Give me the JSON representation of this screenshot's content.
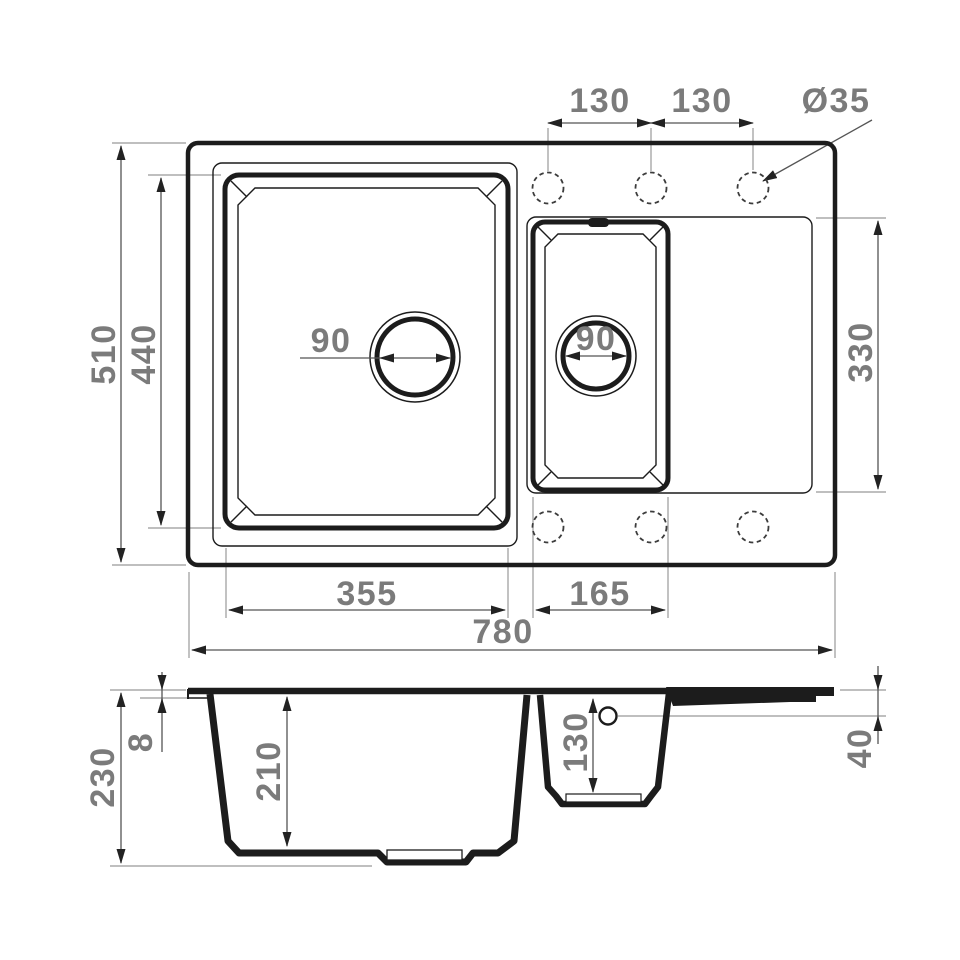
{
  "drawing": {
    "kind": "kitchen-sink-dimension-drawing",
    "units": "mm",
    "views": [
      "top-view",
      "section-view"
    ]
  },
  "top_view": {
    "tap_spacing_left": "130",
    "tap_spacing_right": "130",
    "tap_hole_diameter": "Ø35",
    "overall_depth": "510",
    "main_bowl_depth": "440",
    "main_drain_diameter": "90",
    "small_drain_diameter": "90",
    "drainboard_depth": "330",
    "main_bowl_width": "355",
    "small_bowl_width": "165",
    "overall_width": "780"
  },
  "section_view": {
    "overall_height": "230",
    "rim_thickness": "8",
    "main_bowl_depth": "210",
    "small_bowl_depth": "130",
    "overflow_offset": "40"
  },
  "colors": {
    "outline": "#1c1c1c",
    "dimension_line": "#555555",
    "extension_line": "#999999",
    "dimension_text": "#7b7b7b",
    "background": "#ffffff"
  }
}
